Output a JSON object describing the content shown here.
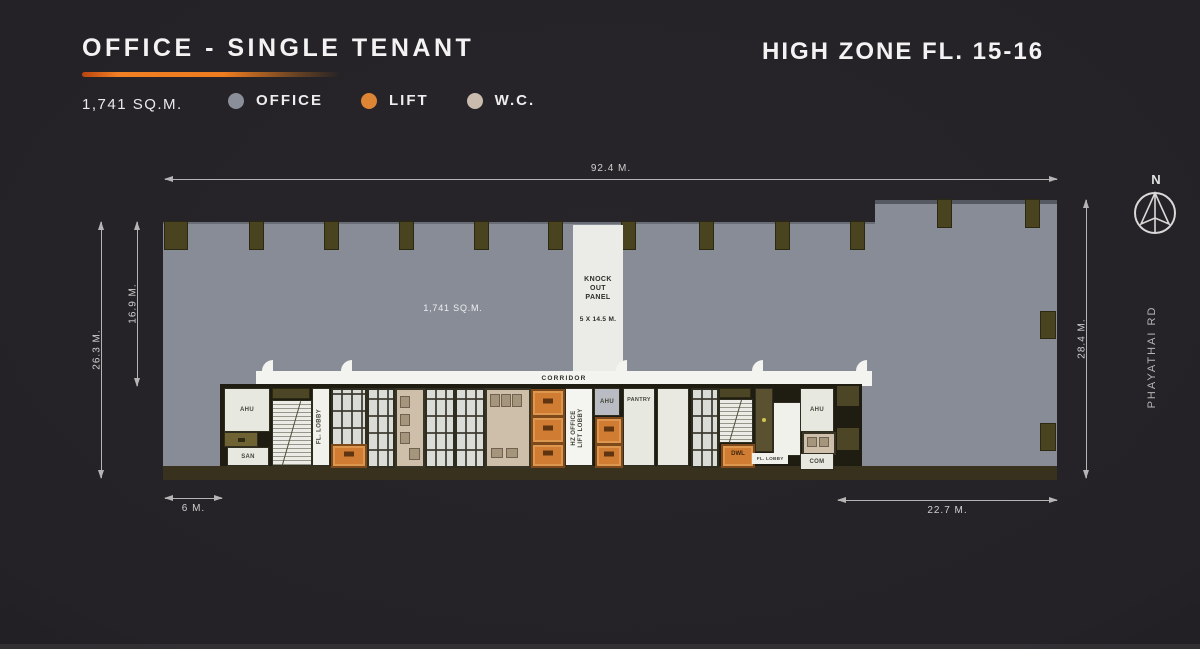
{
  "header": {
    "title": "OFFICE - SINGLE TENANT",
    "zone_title": "HIGH ZONE FL. 15-16",
    "area_label": "1,741 SQ.M.",
    "legend": {
      "office": "OFFICE",
      "lift": "LIFT",
      "wc": "W.C."
    }
  },
  "colors": {
    "accent_orange": "#ee7c20",
    "office": "#878c96",
    "lift": "#d07c33",
    "wc": "#c9bcae"
  },
  "plan": {
    "floor_area": "1,741 SQ.M.",
    "knock_out_panel": {
      "title_lines": [
        "KNOCK",
        "OUT",
        "PANEL"
      ],
      "size": "5 X 14.5 M."
    },
    "corridor": "CORRIDOR",
    "rooms": {
      "ahu_left": "AHU",
      "san": "SAN",
      "fl_lobby_left": "FL. LOBBY",
      "hz_lift_lobby_line1": "HZ OFFICE",
      "hz_lift_lobby_line2": "LIFT LOBBY",
      "ahu_mid": "AHU",
      "pantry": "PANTRY",
      "service_lift": "DWL",
      "fl_lobby_right": "FL. LOBBY",
      "ahu_right": "AHU",
      "com": "COM"
    },
    "dimensions": {
      "top": "92.4 M.",
      "left_outer": "26.3 M.",
      "left_inner": "16.9 M.",
      "right": "28.4 M.",
      "bottom_left": "6 M.",
      "bottom_right": "22.7 M."
    },
    "compass_label": "N",
    "road_label": "PHAYATHAI RD"
  }
}
